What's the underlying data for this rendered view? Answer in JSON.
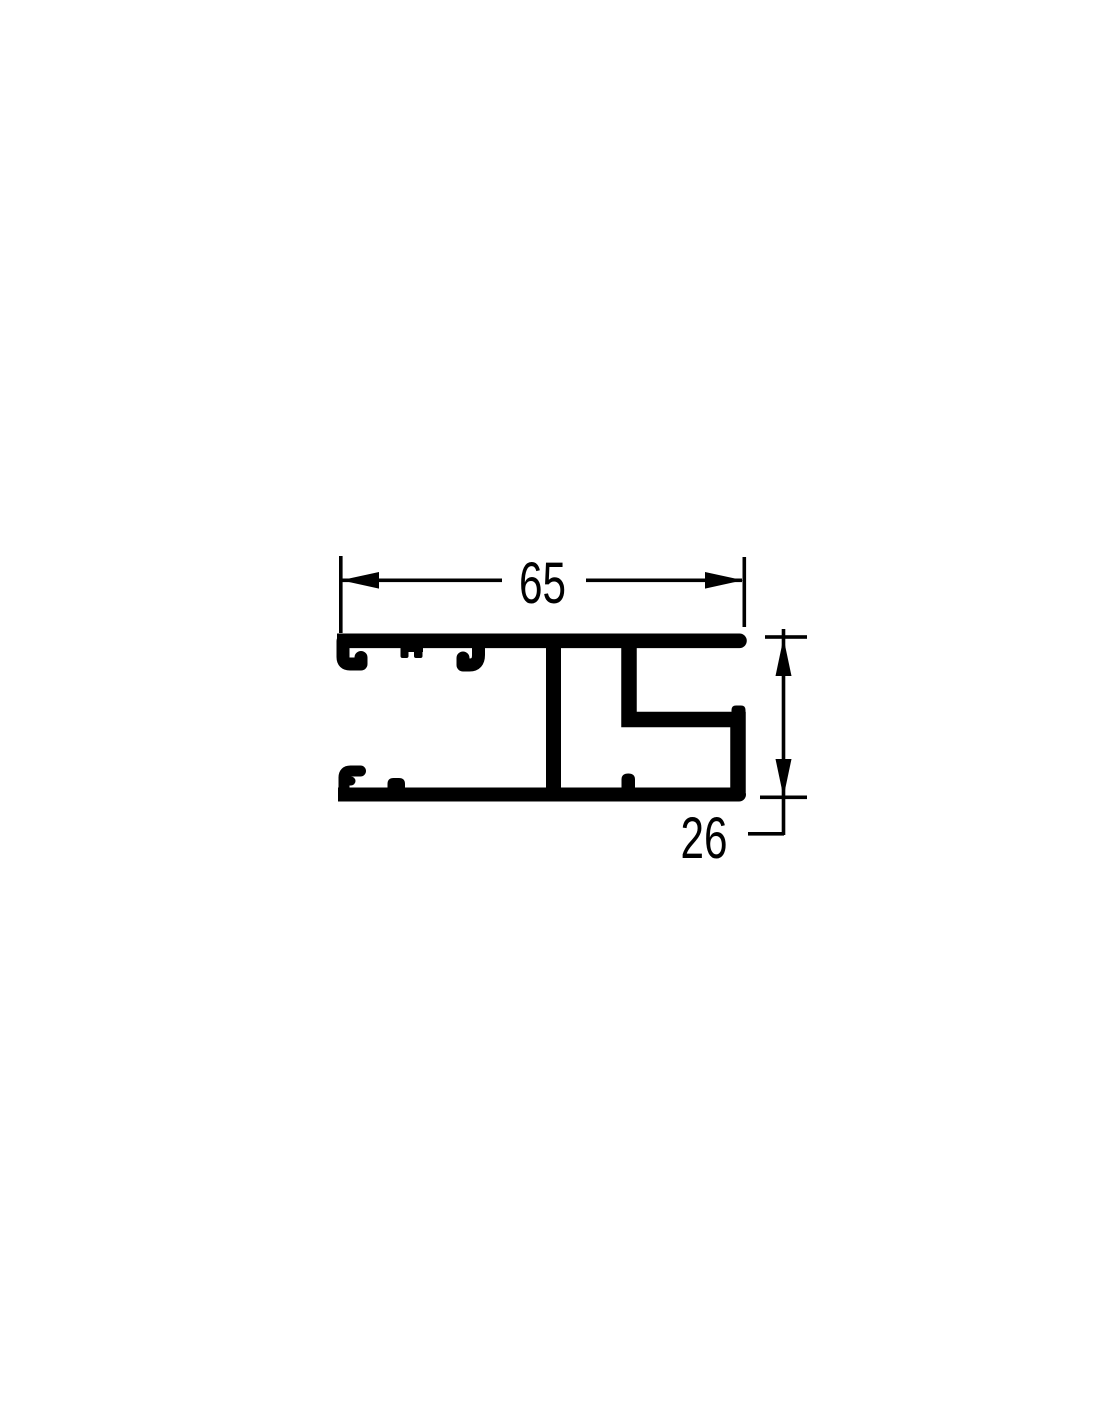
{
  "page": {
    "background_color": "#ffffff",
    "ink_color": "#000000"
  },
  "drawing": {
    "kind": "aluminium-extrusion-profile-cross-section",
    "view": "end-view technical drawing, black line art on white",
    "width_dimension": {
      "value": "65"
    },
    "height_dimension": {
      "value": "26"
    }
  }
}
